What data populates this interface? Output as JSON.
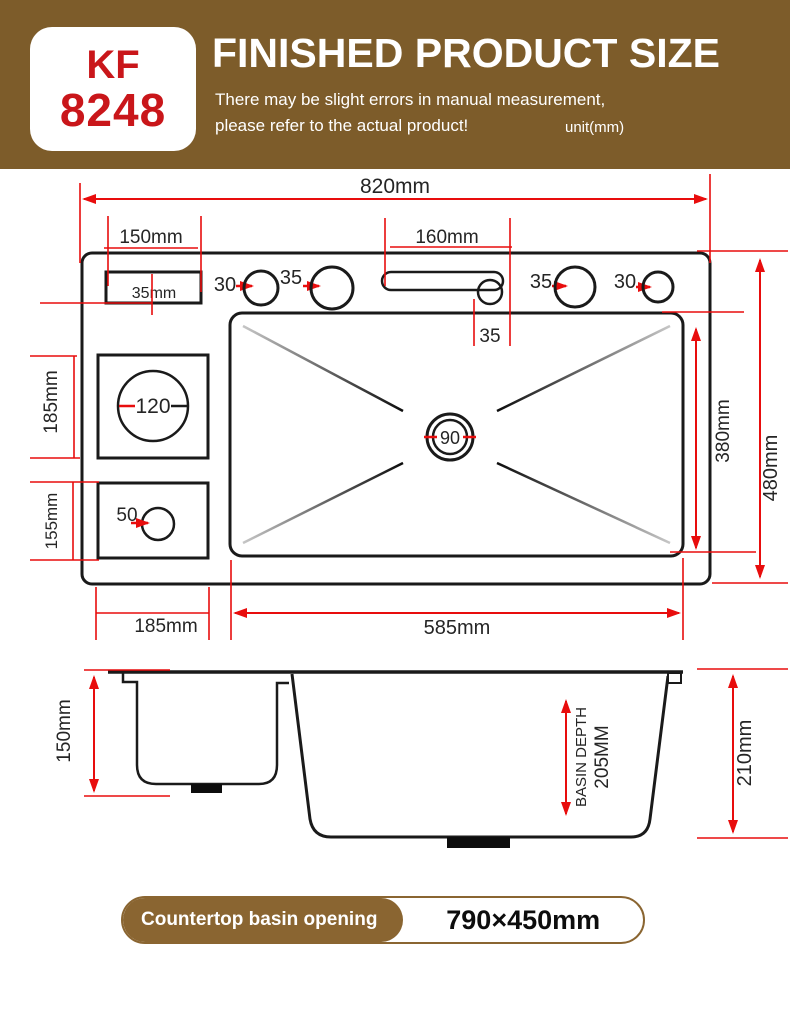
{
  "header": {
    "model_line1": "KF",
    "model_line2": "8248",
    "title": "FINISHED PRODUCT SIZE",
    "subtitle_line1": "There may be slight errors in manual measurement,",
    "subtitle_line2": "please refer to the actual product!",
    "unit_note": "unit(mm)"
  },
  "top_view": {
    "dim_overall_width": "820mm",
    "dim_left_section": "150mm",
    "soap_dispenser_dim": "35mm",
    "hole_left_small": "30",
    "hole_left_large": "35",
    "dim_slot_width": "160mm",
    "dim_slot_hole": "35",
    "hole_right_large": "35",
    "hole_right_small": "30",
    "dim_left_upper": "185mm",
    "dim_left_lower": "155mm",
    "hole_square_upper": "120",
    "hole_square_lower": "50",
    "drain_hole": "90",
    "dim_basin_height": "380mm",
    "dim_overall_height": "480mm",
    "dim_bottom_left": "185mm",
    "dim_basin_width": "585mm"
  },
  "side_view": {
    "dim_left_depth": "150mm",
    "basin_depth_label": "BASIN DEPTH",
    "basin_depth_value": "205MM",
    "dim_right_depth": "210mm"
  },
  "footer": {
    "label": "Countertop basin opening",
    "value": "790×450mm"
  },
  "colors": {
    "header_brown": "#7d5c2a",
    "pill_brown": "#8a6531",
    "model_red": "#c9161a",
    "dimension_red": "#e80d0d",
    "line_black": "#1a1a1a"
  }
}
